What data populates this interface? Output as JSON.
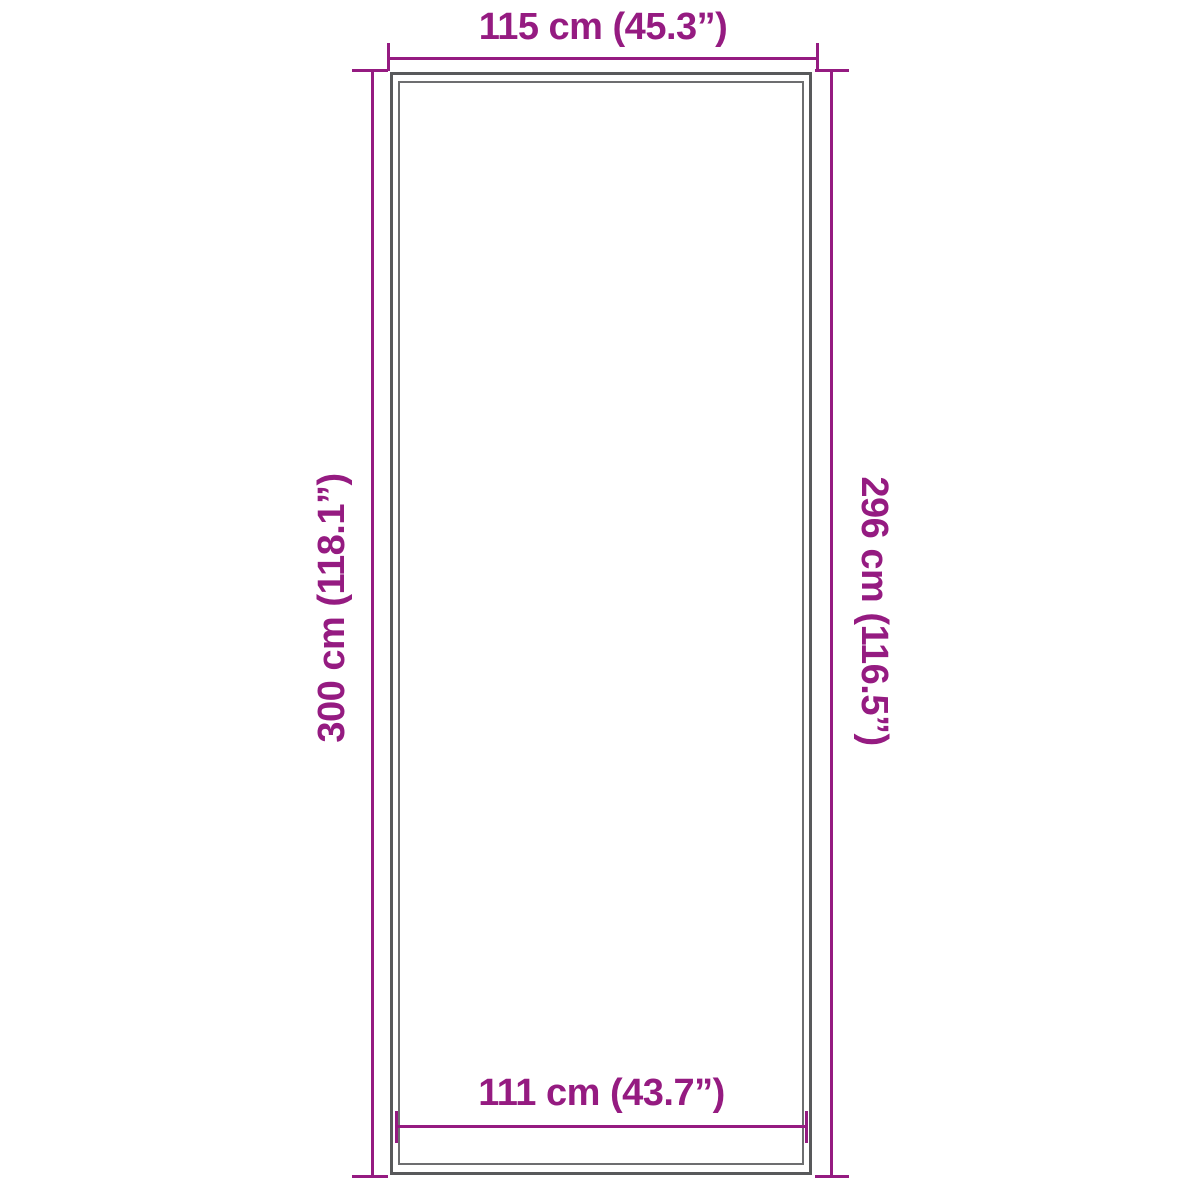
{
  "diagram": {
    "kind": "product-dimension-diagram",
    "colors": {
      "dimension_line": "#951b81",
      "outline_outer": "#58595b",
      "outline_inner": "#6d6e70",
      "background": "#ffffff"
    },
    "measurements": {
      "top_width": "115 cm (45.3”)",
      "bottom_inner_width": "111 cm (43.7”)",
      "left_height": "300 cm (118.1”)",
      "right_inner_height": "296 cm (116.5”)"
    }
  }
}
